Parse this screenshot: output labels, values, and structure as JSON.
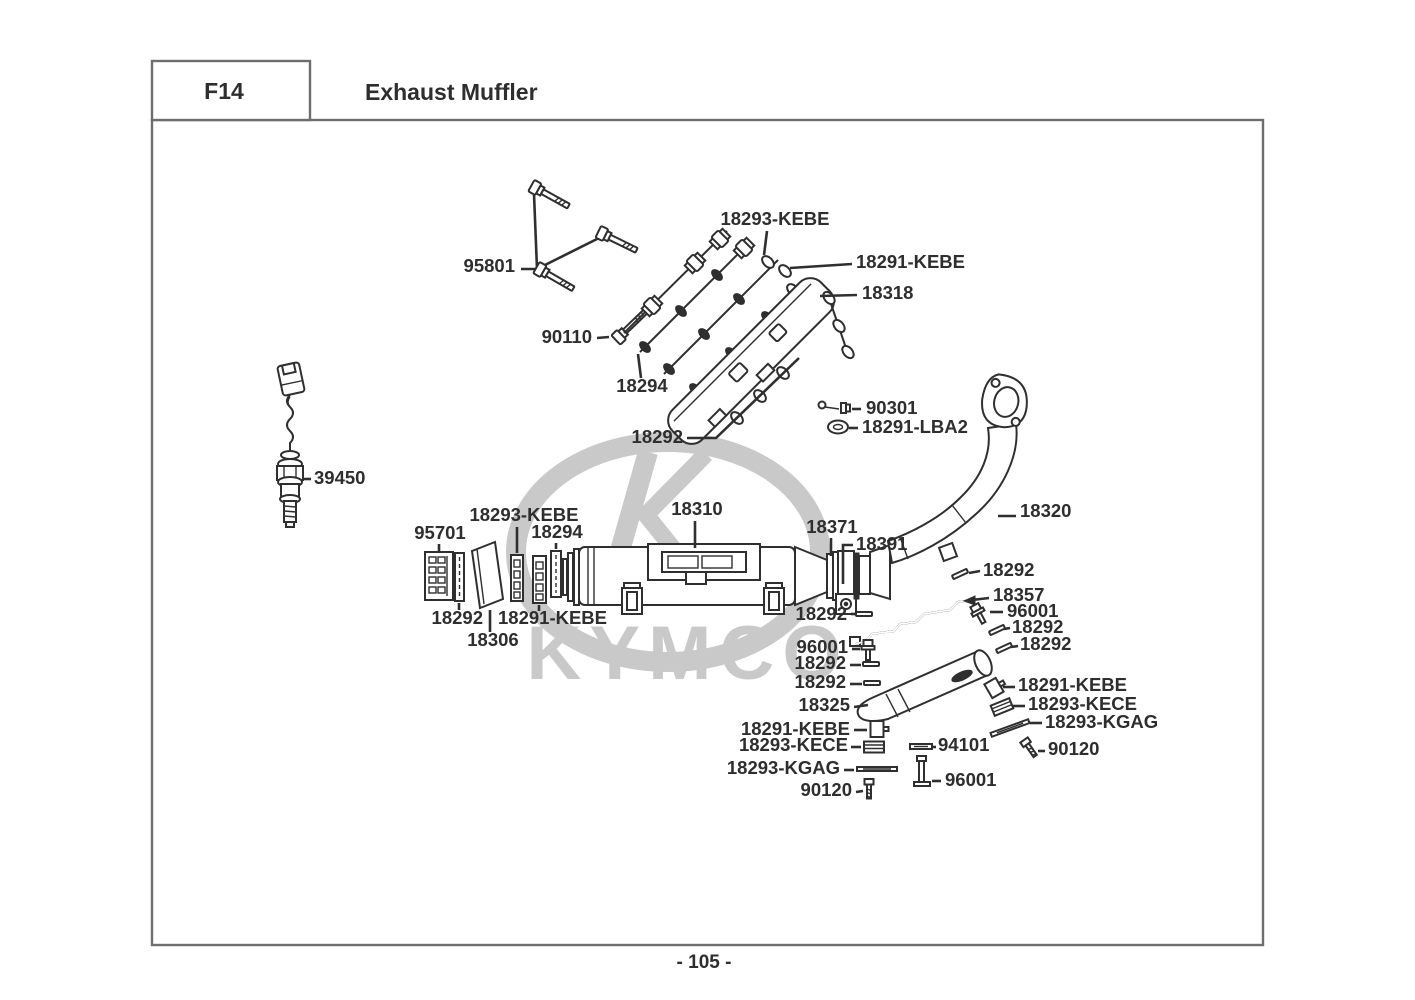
{
  "page": {
    "section_code": "F14",
    "title": "Exhaust Muffler",
    "page_number": "- 105 -",
    "watermark_brand": "KYMCO"
  },
  "colors": {
    "line": "#2f2f2f",
    "label_text": "#2e2e2e",
    "frame": "#6e6e6e",
    "watermark": "#c9c9c9",
    "background": "#ffffff"
  },
  "labels": [
    {
      "text": "95801"
    },
    {
      "text": "18293-KEBE"
    },
    {
      "text": "18291-KEBE"
    },
    {
      "text": "18318"
    },
    {
      "text": "90110"
    },
    {
      "text": "18294"
    },
    {
      "text": "18292"
    },
    {
      "text": "90301"
    },
    {
      "text": "18291-LBA2"
    },
    {
      "text": "39450"
    },
    {
      "text": "95701"
    },
    {
      "text": "18293-KEBE"
    },
    {
      "text": "18294"
    },
    {
      "text": "18310"
    },
    {
      "text": "18371"
    },
    {
      "text": "18391"
    },
    {
      "text": "18320"
    },
    {
      "text": "18292"
    },
    {
      "text": "18292"
    },
    {
      "text": "18357"
    },
    {
      "text": "96001"
    },
    {
      "text": "18292"
    },
    {
      "text": "18292"
    },
    {
      "text": "96001"
    },
    {
      "text": "18292"
    },
    {
      "text": "18292"
    },
    {
      "text": "18325"
    },
    {
      "text": "18291-KEBE"
    },
    {
      "text": "18293-KECE"
    },
    {
      "text": "18293-KGAG"
    },
    {
      "text": "90120"
    },
    {
      "text": "18291-KEBE"
    },
    {
      "text": "18293-KECE"
    },
    {
      "text": "94101"
    },
    {
      "text": "18293-KGAG"
    },
    {
      "text": "90120"
    },
    {
      "text": "96001"
    },
    {
      "text": "18292"
    },
    {
      "text": "18291-KEBE"
    },
    {
      "text": "18306"
    }
  ]
}
